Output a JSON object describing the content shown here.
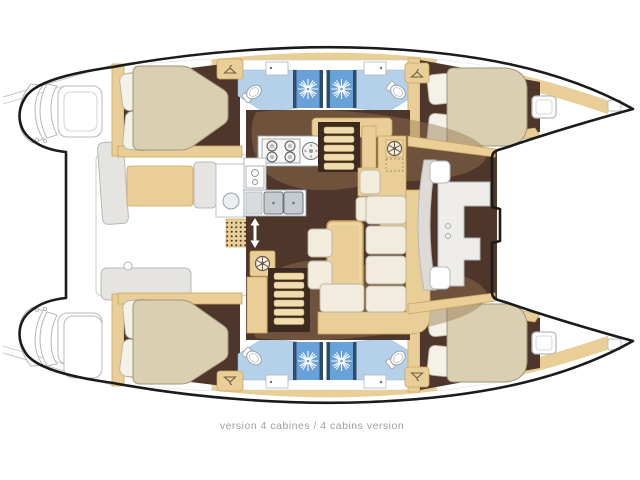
{
  "caption": {
    "text": "version 4 cabines / 4 cabins version"
  },
  "colors": {
    "outline": "#1b1b1b",
    "hullBand": "#e9cf97",
    "woodDark": "#c8a55f",
    "woodLight": "#f0dcae",
    "floorBrown": "#4e362a",
    "floorBrownDark": "#3b2a1f",
    "bedCream": "#dbcfb1",
    "bedStroke": "#a2947a",
    "cushionCream": "#f1ecdd",
    "cushionStroke": "#b9b3a0",
    "bathFloorBlue": "#b5d1e9",
    "showerBlue": "#68a0d8",
    "showerNavy": "#2f4c68",
    "steel": "#c6cbd0",
    "lineGray": "#b4b8bb",
    "softGray": "#e6e4e0",
    "tanShade": "#96764f",
    "captionGray": "#9aa0a5",
    "white": "#ffffff"
  },
  "icons": {
    "shower_jet": "sunburst-jet-icon",
    "wardrobe": "clothes-hanger-icon",
    "stove": "four-burner-stove-icon",
    "helm_wheel": "spoked-wheel-icon",
    "companionway": "double-arrow-icon"
  }
}
